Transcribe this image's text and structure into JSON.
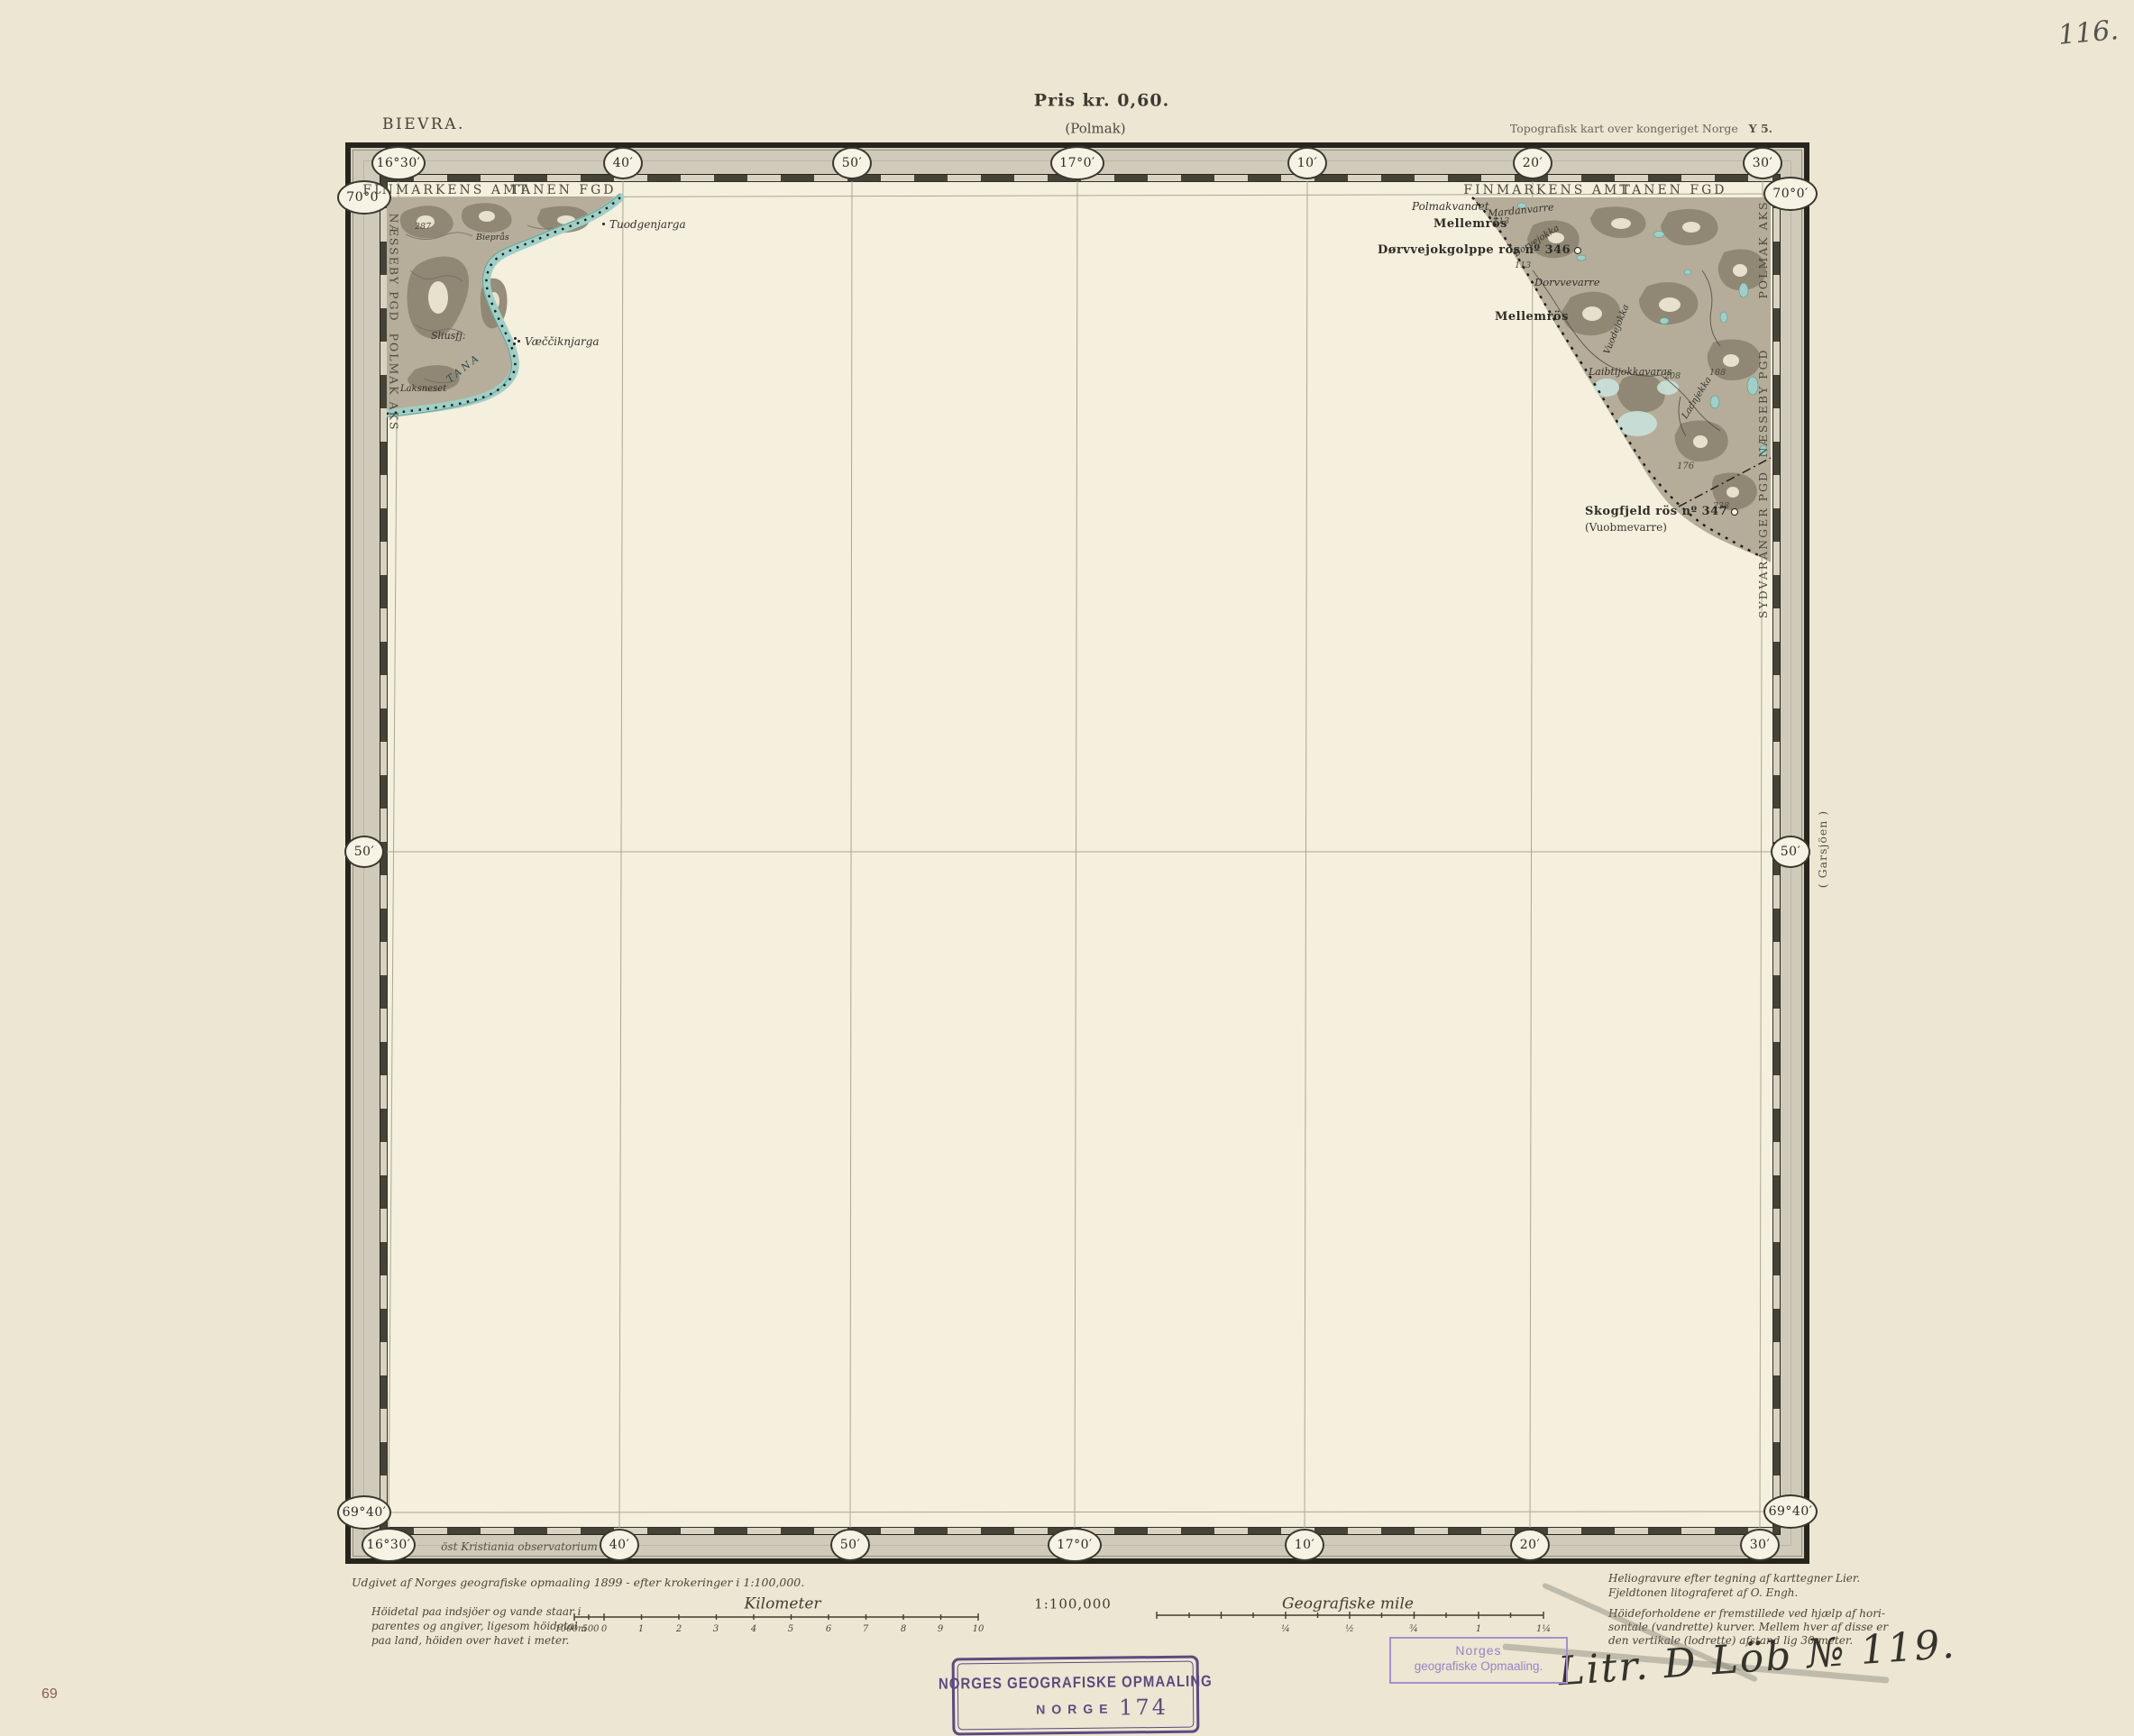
{
  "colors": {
    "paper": "#ece6d2",
    "map_face": "#f5efdd",
    "frame_black": "#26241c",
    "band_gray": "#cfcaba",
    "water_teal": "#9fcfc6",
    "terrain_gray": "#b6ae9b",
    "stamp_purple": "#5d4a80",
    "stamp_light_purple": "#9c82c6",
    "page_no_red": "#8a5f52"
  },
  "page": {
    "handwritten_no": "116.",
    "price": "Pris kr. 0,60.",
    "sheet_name": "BIEVRA.",
    "sheet_alt": "(Polmak)",
    "series_title": "Topografisk kart over kongeriget Norge",
    "sheet_code": "Y 5.",
    "page_no": "69"
  },
  "graticule": {
    "top": [
      "16°30′",
      "40′",
      "50′",
      "17°0′",
      "10′",
      "20′",
      "30′"
    ],
    "bottom": [
      "16°30′",
      "40′",
      "50′",
      "17°0′",
      "10′",
      "20′",
      "30′"
    ],
    "left": [
      "70°0′",
      "50′",
      "69°40′"
    ],
    "right": [
      "70°0′",
      "50′",
      "69°40′"
    ],
    "bottom_note": "öst Kristiania observatorium",
    "right_margin_note": "( Garsjöen )"
  },
  "admin": {
    "nw_amt": "FINMARKENS AMT",
    "nw_fgd": "TANEN FGD",
    "ne_amt": "FINMARKENS AMT",
    "ne_fgd": "TANEN FGD",
    "left_edge": [
      "NÆSSEBY PGD",
      "POLMAK AKS"
    ],
    "right_edge": [
      "POLMAK AKS",
      "NÆSSEBY PGD",
      "SYDVARANGER PGD"
    ]
  },
  "map_labels": {
    "nw": [
      {
        "text": "Tuodgenjarga"
      },
      {
        "text": "Væččiknjarga"
      },
      {
        "text": "Sliusfj."
      },
      {
        "text": "Laksneset"
      },
      {
        "text": "TANA"
      },
      {
        "text": "287"
      },
      {
        "text": "Bieprås"
      }
    ],
    "ne": [
      {
        "text": "Polmakvandet"
      },
      {
        "text": "Mellemrös"
      },
      {
        "text": "Dørvvejokgolppe rös nº 346"
      },
      {
        "text": "Mardanvarre"
      },
      {
        "text": "113"
      },
      {
        "text": "Borvejokka"
      },
      {
        "text": "Dorvvevarre"
      },
      {
        "text": "113"
      },
      {
        "text": "Mellemrös"
      },
      {
        "text": "Vuodejokka"
      },
      {
        "text": "Laibtijokkavaras"
      },
      {
        "text": "208"
      },
      {
        "text": "188"
      },
      {
        "text": "176"
      },
      {
        "text": "238"
      },
      {
        "text": "Ladnjekka"
      },
      {
        "text": "Skogfjeld rös nº 347"
      },
      {
        "text": "(Vuobmevarre)"
      }
    ]
  },
  "legend": {
    "publisher_line": "Udgivet af Norges geografiske opmaaling 1899 - efter krokeringer i 1:100,000.",
    "note_left": [
      "Höidetal paa indsjöer og vande staar i",
      "parentes og angiver, ligesom höidetal",
      "paa land, höiden over havet i meter."
    ],
    "km_title": "Kilometer",
    "km_ticks": [
      "1000m",
      "500",
      "0",
      "1",
      "2",
      "3",
      "4",
      "5",
      "6",
      "7",
      "8",
      "9",
      "10"
    ],
    "scale_ratio": "1:100,000",
    "mile_title": "Geografiske mile",
    "mile_ticks": [
      "¼",
      "½",
      "¾",
      "1",
      "1¼"
    ],
    "credit_lines": [
      "Heliogravure efter tegning af karttegner Lier.",
      "Fjeldtonen litograferet af O. Engh."
    ],
    "contour_note": [
      "Höideforholdene er fremstillede ved hjælp af hori-",
      "sontale (vandrette) kurver. Mellem hver af disse er",
      "den vertikale (lodrette) afstand lig 30 meter."
    ],
    "handwritten_litr": "Litr. D Löb № 119."
  },
  "stamps": {
    "main": {
      "line1": "NORGES GEOGRAFISKE OPMAALING",
      "line2": "NORGE",
      "number": "174"
    },
    "small": {
      "line1": "Norges",
      "line2": "geografiske Opmaaling."
    }
  }
}
